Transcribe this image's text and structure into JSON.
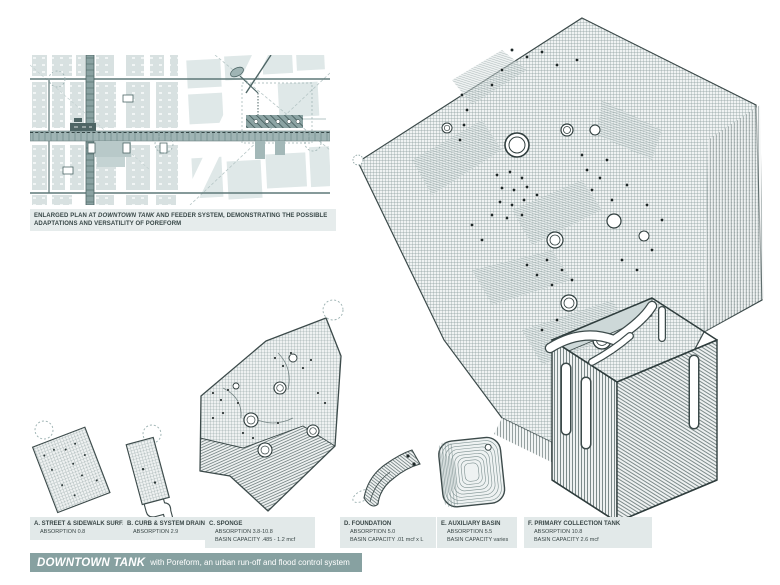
{
  "caption": {
    "prefix": "ENLARGED PLAN AT ",
    "emph": "DOWNTOWN TANK",
    "suffix": " AND FEEDER SYSTEM, DEMONSTRATING THE POSSIBLE ADAPTATIONS AND VERSATILITY OF POREFORM"
  },
  "legend": {
    "items": [
      {
        "title": "A. STREET & SIDEWALK SURFACE",
        "absorption": "ABSORPTION 0.8"
      },
      {
        "title": "B. CURB & SYSTEM DRAIN",
        "absorption": "ABSORPTION 2.9"
      },
      {
        "title": "C. SPONGE",
        "absorption": "ABSORPTION 3.8-10.8",
        "capacity": "BASIN CAPACITY .485 - 1.2 mcf"
      },
      {
        "title": "D. FOUNDATION",
        "absorption": "ABSORPTION 5.0",
        "capacity": "BASIN CAPACITY .01 mcf x L"
      },
      {
        "title": "E. AUXILIARY BASIN",
        "absorption": "ABSORPTION 5.5",
        "capacity": "BASIN CAPACITY varies"
      },
      {
        "title": "F. PRIMARY COLLECTION TANK",
        "absorption": "ABSORPTION 10.8",
        "capacity": "BASIN CAPACITY 2.6 mcf"
      }
    ]
  },
  "titlebar": {
    "title": "DOWNTOWN TANK",
    "subtitle": "with Poreform, an urban run-off and flood control system"
  },
  "colors": {
    "accent_bar": "#87a1a1",
    "strip_bg": "#e2e9e9",
    "ink": "#3c4a4a",
    "mesh_line": "#7d8d8d",
    "plan_band": "#9fb4b4"
  }
}
